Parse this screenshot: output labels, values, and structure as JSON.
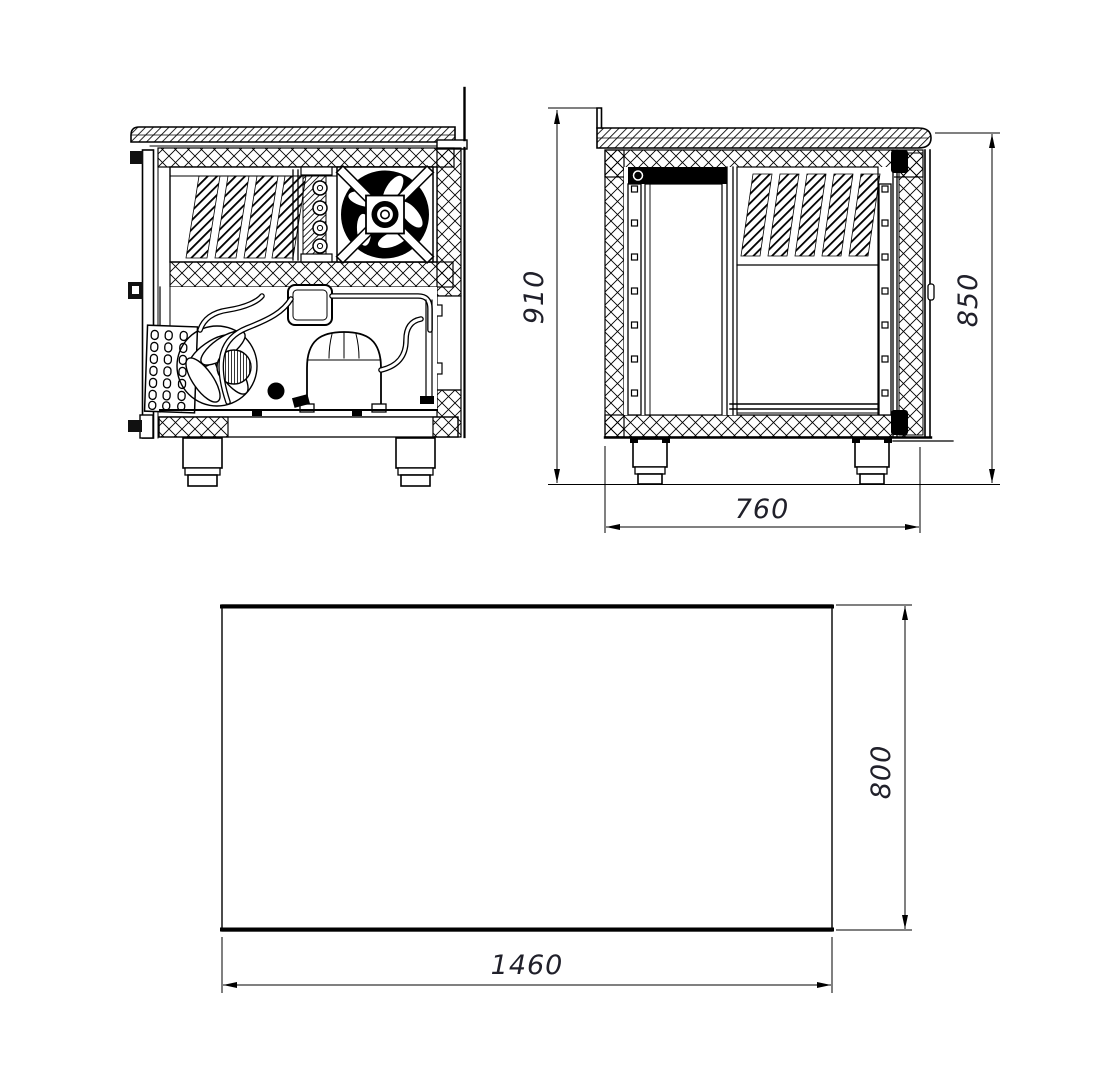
{
  "drawing": {
    "title": "refrigerated counter three-view technical drawing",
    "views": {
      "front": {
        "name": "front view (machinery compartment)"
      },
      "side": {
        "name": "side view",
        "dimensions": {
          "overall_height": "910",
          "body_height": "850",
          "depth": "760"
        }
      },
      "plan": {
        "name": "plan view",
        "dimensions": {
          "width": "1460",
          "depth": "800"
        }
      }
    },
    "colors": {
      "line": "#000000",
      "dim_text": "#20202a",
      "background": "#ffffff"
    }
  }
}
